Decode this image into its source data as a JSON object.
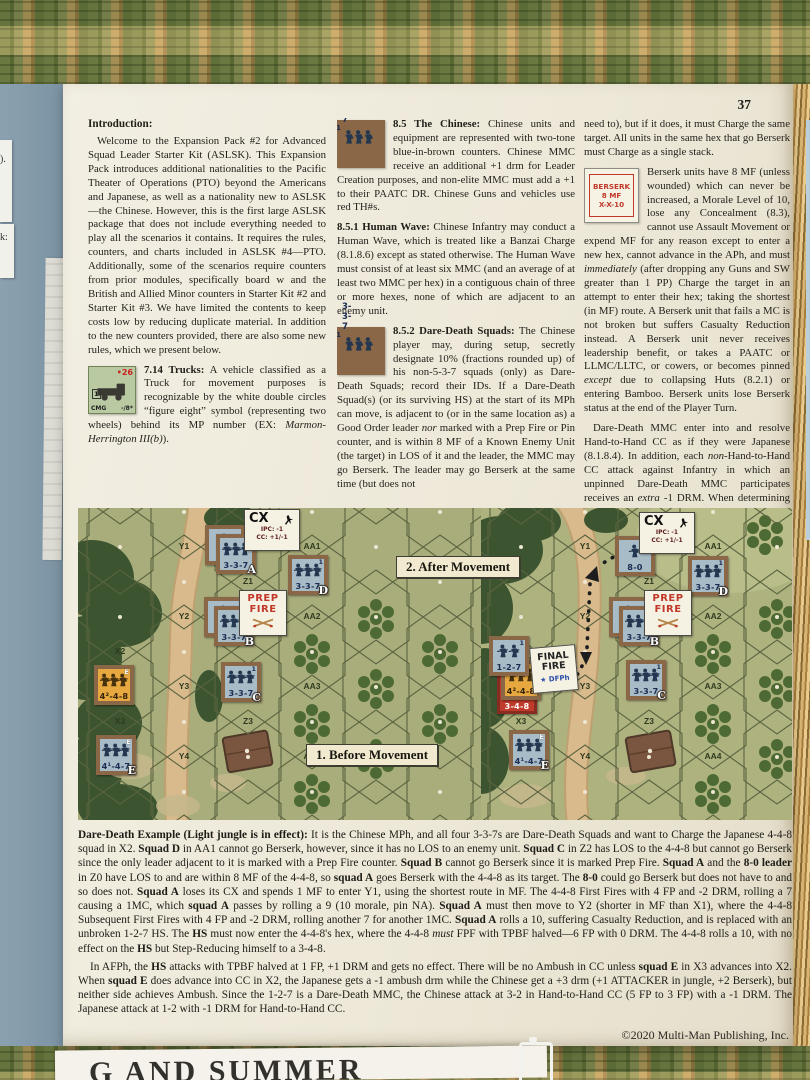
{
  "page_number": "37",
  "copyright": "©2020 Multi-Man Publishing, Inc.",
  "surroundings": {
    "scrap1": ").",
    "scrap2": "k:",
    "bottom_text": "G AND SUMMER"
  },
  "col1": {
    "heading": "Introduction:",
    "p1": [
      {
        "t": "Welcome to the Expansion Pack #2 for Advanced Squad Leader Starter Kit (ASLSK). This Expansion Pack introduces additional nationalities to the Pacific Theater of Operations (PTO) beyond the Americans and Japanese, as well as a nationality new to ASLSK—the Chinese. However, this is the first large ASLSK package that does not include everything needed to play all the scenarios it contains. It requires the rules, counters, and charts included in ASLSK #4—PTO. Additionally, some of the scenarios require counters from prior modules, specifically board w and the British and Allied Minor counters in Starter Kit #2 and Starter Kit #3. We have limited the contents to keep costs low by reducing duplicate material. In addition to the new counters provided, there are also some new rules, which we present below."
      }
    ],
    "trucks": [
      {
        "b": "7.14 Trucks:"
      },
      {
        "t": " A vehicle classified as a Truck for movement purposes is recognizable by the white double circles “figure eight” symbol (representing two wheels) behind its MP number (EX: "
      },
      {
        "i": "Marmon-Herrington III(b)"
      },
      {
        "t": ")."
      }
    ]
  },
  "col2": {
    "p85": [
      {
        "b": "8.5 The Chinese:"
      },
      {
        "t": " Chinese units and equipment are represented with two-tone blue-in-brown counters. Chinese MMC receive an additional +1 drm for Leader Creation purposes, and non-elite MMC must add a +1 to their PAATC DR. Chinese Guns and vehicles use red TH#s."
      }
    ],
    "p851": [
      {
        "b": "8.5.1 Human Wave:"
      },
      {
        "t": " Chinese Infantry may conduct a Human Wave, which is treated like a Banzai Charge (8.1.8.6) except as stated otherwise. The Human Wave must consist of at least six MMC (and an average of at least two MMC per hex) in a contiguous chain of three or more hexes, none of which are adjacent to an enemy unit."
      }
    ],
    "p852": [
      {
        "b": "8.5.2 Dare-Death Squads:"
      },
      {
        "t": " The Chinese player may, during setup, secretly designate 10% (fractions rounded up) of his non-5-3-7 squads (only) as Dare-Death Squads; record their IDs. If a Dare-Death Squad(s) (or its surviving HS) at the start of its MPh can move, is adjacent to (or in the same location as) a Good Order leader "
      },
      {
        "i": "nor"
      },
      {
        "t": " marked with a Prep Fire or Pin counter, and is within 8 MF of a Known Enemy Unit (the target) in LOS of it and the leader, the MMC may go Berserk. The leader may go Berserk at the same time (but does not"
      }
    ]
  },
  "col3": {
    "p1": [
      {
        "t": "need to), but if it does, it must Charge the same target. All units in the same hex that go Berserk must Charge as a single stack."
      }
    ],
    "p2": [
      {
        "t": "Berserk units have 8 MF (unless wounded) which can never be increased, a Morale Level of 10, lose any Concealment (8.3), cannot use Assault Movement or expend MF for any reason except to enter a new hex, cannot advance in the APh, and must "
      },
      {
        "i": "immediately"
      },
      {
        "t": " (after dropping any Guns and SW greater than 1 PP) Charge the target in an attempt to enter their hex; taking the shortest (in MF) route. A Berserk unit that fails a MC is not broken but suffers Casualty Reduction instead. A Berserk unit never receives leadership benefit, or takes a PAATC or LLMC/LLTC, or cowers, or becomes pinned "
      },
      {
        "i": "except"
      },
      {
        "t": " due to collapsing Huts (8.2.1) or entering Bamboo. Berserk units lose Berserk status at the end of the Player Turn."
      }
    ],
    "p3": [
      {
        "t": "Dare-Death MMC enter into and resolve Hand-to-Hand CC as if they were Japanese (8.1.8.4). In addition, each "
      },
      {
        "i": "non"
      },
      {
        "t": "-Hand-to-Hand CC attack against Infantry in which an unpinned Dare-Death MMC participates receives an "
      },
      {
        "i": "extra"
      },
      {
        "t": " -1 DRM. When determining ambush, Berserk units receive both the +1 Inexperienced (5.4) drm and a +1 Berserk drm."
      }
    ]
  },
  "counters_inline": {
    "truck": {
      "badge": "•26",
      "side": "1",
      "bl": "CMG",
      "br": "-/8*"
    },
    "chinese": {
      "num": "5-3-7",
      "sup": "1"
    },
    "daredeath": {
      "num": "3-3-7",
      "sup": "1"
    },
    "berserk": {
      "l1": "BERSERK",
      "l2": "8 MF",
      "l3": "X-X-10"
    }
  },
  "example": {
    "p1": [
      {
        "b": "Dare-Death Example (Light jungle is in effect):"
      },
      {
        "t": " It is the Chinese MPh, and all four 3-3-7s are Dare-Death Squads and want to Charge the Japanese 4-4-8 squad in X2. "
      },
      {
        "b": "Squad D"
      },
      {
        "t": " in AA1 cannot go Berserk, however, since it has no LOS to an enemy unit. "
      },
      {
        "b": "Squad C"
      },
      {
        "t": " in Z2 has LOS to the 4-4-8 but cannot go Berserk since the only leader adjacent to it is marked with a Prep Fire counter. "
      },
      {
        "b": "Squad B"
      },
      {
        "t": " cannot go Berserk since it is marked Prep Fire. "
      },
      {
        "b": "Squad A"
      },
      {
        "t": " and the "
      },
      {
        "b": "8-0 leader"
      },
      {
        "t": " in Z0 have LOS to and are within 8 MF of the 4-4-8, so "
      },
      {
        "b": "squad A"
      },
      {
        "t": " goes Berserk with the 4-4-8 as its target. The "
      },
      {
        "b": "8-0"
      },
      {
        "t": " could go Berserk but does not have to and so does not. "
      },
      {
        "b": "Squad A"
      },
      {
        "t": " loses its CX and spends 1 MF to enter Y1, using the shortest route in MF. The 4-4-8 First Fires with 4 FP and -2 DRM, rolling a 7 causing a 1MC, which "
      },
      {
        "b": "squad A"
      },
      {
        "t": " passes by rolling a 9 (10 morale, pin NA). "
      },
      {
        "b": "Squad A"
      },
      {
        "t": " must then move to Y2 (shorter in MF than X1), where the 4-4-8 Subsequent First Fires with 4 FP and -2 DRM, rolling another 7 for another 1MC. "
      },
      {
        "b": "Squad A"
      },
      {
        "t": " rolls a 10, suffering Casualty Reduction, and is replaced with an unbroken 1-2-7 HS. The "
      },
      {
        "b": "HS"
      },
      {
        "t": " must now enter the 4-4-8's hex, where the 4-4-8 "
      },
      {
        "i": "must"
      },
      {
        "t": " FPF with TPBF halved—6 FP with 0 DRM. The 4-4-8 rolls a 10, with no effect on the "
      },
      {
        "b": "HS"
      },
      {
        "t": " but Step-Reducing himself to a 3-4-8."
      }
    ],
    "p2": [
      {
        "t": "In AFPh, the "
      },
      {
        "b": "HS"
      },
      {
        "t": " attacks with TPBF halved at 1 FP, +1 DRM and gets no effect. There will be no Ambush in CC unless "
      },
      {
        "b": "squad E"
      },
      {
        "t": " in X3 advances into X2. When "
      },
      {
        "b": "squad E"
      },
      {
        "t": " does advance into CC in X2, the Japanese gets a -1 ambush drm while the Chinese get a +3 drm (+1 ATTACKER in jungle, +2 Berserk), but neither side achieves Ambush. Since the 1-2-7 is a Dare-Death MMC, the Chinese attack at 3-2 in Hand-to-Hand CC (5 FP to 3 FP) with a -1 DRM. The Japanese attack at 1-2 with -1 DRM for Hand-to-Hand CC."
      }
    ]
  },
  "map": {
    "captions": {
      "before": "1. Before Movement",
      "after": "2. After Movement"
    },
    "marker_defs": {
      "cx": {
        "title": "CX",
        "lines": [
          "IPC:  -1",
          "CC: +1/-1"
        ]
      },
      "prep": {
        "lines": [
          "PREP",
          "FIRE"
        ]
      },
      "final": {
        "lines": [
          "FINAL",
          "FIRE"
        ],
        "sub": "DFPh"
      }
    },
    "panels": [
      {
        "id": "before",
        "hex_labels": [
          {
            "t": "Y1",
            "x": 106,
            "y": 33
          },
          {
            "t": "Y2",
            "x": 106,
            "y": 103
          },
          {
            "t": "Y3",
            "x": 106,
            "y": 173
          },
          {
            "t": "Y4",
            "x": 106,
            "y": 243
          },
          {
            "t": "X2",
            "x": 42,
            "y": 138
          },
          {
            "t": "X3",
            "x": 42,
            "y": 208
          },
          {
            "t": "Z1",
            "x": 170,
            "y": 68
          },
          {
            "t": "Z3",
            "x": 170,
            "y": 208
          },
          {
            "t": "AA1",
            "x": 234,
            "y": 33
          },
          {
            "t": "AA2",
            "x": 234,
            "y": 103
          },
          {
            "t": "AA3",
            "x": 234,
            "y": 173
          },
          {
            "t": "AA4",
            "x": 234,
            "y": 243
          }
        ],
        "counters": [
          {
            "cls": "ch1",
            "x": 127,
            "y": 17,
            "num": "8-0",
            "name": "counter-leader-8-0"
          },
          {
            "cls": "ch3",
            "x": 138,
            "y": 26,
            "num": "3-3-7",
            "sup": "1",
            "tag": "A",
            "name": "counter-squad-a"
          },
          {
            "cls": "ch1",
            "x": 126,
            "y": 89,
            "num": "8-0",
            "name": "counter-leader"
          },
          {
            "cls": "ch3",
            "x": 136,
            "y": 98,
            "num": "3-3-7",
            "sup": "1",
            "tag": "B",
            "name": "counter-squad-b"
          },
          {
            "cls": "ch3",
            "x": 143,
            "y": 154,
            "num": "3-3-7",
            "sup": "1",
            "tag": "C",
            "name": "counter-squad-c"
          },
          {
            "cls": "ch3",
            "x": 210,
            "y": 47,
            "num": "3-3-7",
            "sup": "1",
            "tag": "D",
            "name": "counter-squad-d"
          },
          {
            "cls": "jp3",
            "x": 16,
            "y": 157,
            "num": "4²-4-8",
            "sup": "E",
            "supw": 1,
            "name": "counter-japanese-4-4-8"
          },
          {
            "cls": "ch3",
            "x": 18,
            "y": 227,
            "num": "4¹-4-7",
            "sup": "E",
            "supw": 1,
            "tag": "E",
            "name": "counter-squad-e"
          }
        ],
        "markers": [
          {
            "type": "cx",
            "x": 166,
            "y": 1
          },
          {
            "type": "prep",
            "x": 161,
            "y": 82
          }
        ]
      },
      {
        "id": "after",
        "hex_labels": [
          {
            "t": "Y1",
            "x": 104,
            "y": 33
          },
          {
            "t": "Y2",
            "x": 104,
            "y": 103
          },
          {
            "t": "Y3",
            "x": 104,
            "y": 173
          },
          {
            "t": "Y4",
            "x": 104,
            "y": 243
          },
          {
            "t": "X3",
            "x": 40,
            "y": 208
          },
          {
            "t": "Z1",
            "x": 168,
            "y": 68
          },
          {
            "t": "Z3",
            "x": 168,
            "y": 208
          },
          {
            "t": "AA1",
            "x": 232,
            "y": 33
          },
          {
            "t": "AA2",
            "x": 232,
            "y": 103
          },
          {
            "t": "AA3",
            "x": 232,
            "y": 173
          },
          {
            "t": "AA4",
            "x": 232,
            "y": 243
          }
        ],
        "counters": [
          {
            "cls": "ch1",
            "x": 134,
            "y": 28,
            "num": "8-0",
            "name": "counter-leader-8-0"
          },
          {
            "cls": "ch1",
            "x": 128,
            "y": 89,
            "num": "8-0",
            "name": "counter-leader"
          },
          {
            "cls": "ch3",
            "x": 138,
            "y": 98,
            "num": "3-3-7",
            "sup": "1",
            "tag": "B",
            "name": "counter-squad-b"
          },
          {
            "cls": "ch3",
            "x": 145,
            "y": 152,
            "num": "3-3-7",
            "sup": "1",
            "tag": "C",
            "name": "counter-squad-c"
          },
          {
            "cls": "ch3",
            "x": 207,
            "y": 48,
            "num": "3-3-7",
            "sup": "1",
            "tag": "D",
            "name": "counter-squad-d"
          },
          {
            "cls": "red",
            "x": 16,
            "y": 166,
            "num": "3-4-8",
            "name": "counter-stepreduced-3-4-8"
          },
          {
            "cls": "jp3",
            "x": 20,
            "y": 152,
            "num": "4²-4-8",
            "sup": "E",
            "supw": 1,
            "name": "counter-japanese-4-4-8"
          },
          {
            "cls": "ch2",
            "x": 8,
            "y": 128,
            "num": "1-2-7",
            "sup": "1",
            "name": "counter-halfsquad-1-2-7"
          },
          {
            "cls": "ch3",
            "x": 28,
            "y": 222,
            "num": "4¹-4-7",
            "sup": "E",
            "supw": 1,
            "tag": "E",
            "name": "counter-squad-e"
          }
        ],
        "markers": [
          {
            "type": "cx",
            "x": 158,
            "y": 4
          },
          {
            "type": "prep",
            "x": 163,
            "y": 82
          },
          {
            "type": "final",
            "x": 50,
            "y": 138
          }
        ]
      }
    ]
  }
}
